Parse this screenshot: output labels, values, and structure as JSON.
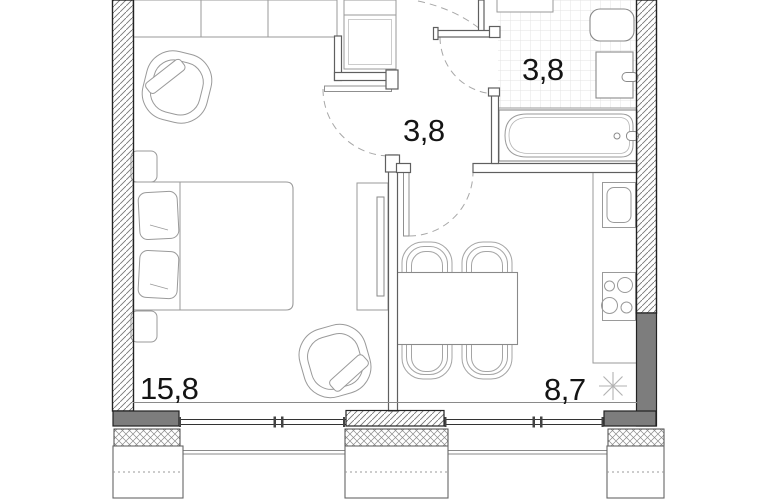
{
  "floor_plan": {
    "title": "apartment-floor-plan",
    "rooms": [
      {
        "id": "living-room",
        "area_label": "15,8"
      },
      {
        "id": "hallway",
        "area_label": "3,8"
      },
      {
        "id": "bathroom",
        "area_label": "3,8"
      },
      {
        "id": "kitchen",
        "area_label": "8,7"
      }
    ],
    "colors": {
      "exterior_wall_dark_fill": "#7d7d7d",
      "exterior_wall_line": "#222222",
      "interior_wall_line": "#5f5f5f",
      "furniture_line": "#9a9a9a",
      "fixture_line": "#8a8a8a",
      "tile_line": "#e3e3e3",
      "door_arc_line": "#a0a0a0",
      "label_text": "#141414"
    },
    "symbols": {
      "ventilation": "asterisk",
      "walls_hatched": "diagonal",
      "insulation": "crosshatch"
    }
  }
}
